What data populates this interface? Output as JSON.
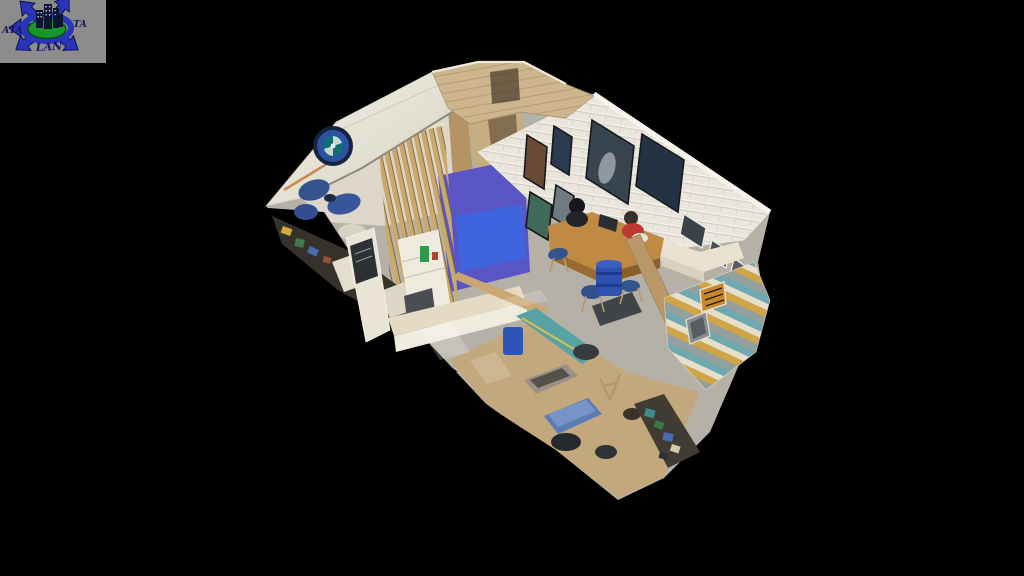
{
  "app": {
    "kind": "3d-dollhouse-tour-viewer",
    "background_color": "#000000"
  },
  "watermark": {
    "text_left": "ATA",
    "text_right": "TA",
    "text_bottom": "LAN",
    "colors": {
      "panel": "#8c8c8c",
      "arrows": "#2935b8",
      "arrow_outline": "#10104f",
      "globe_green": "#18962e",
      "buildings": "#0e1530",
      "windows": "#c8d0e0",
      "text": "#181864"
    }
  },
  "scene": {
    "kind": "dollhouse-cutaway",
    "features": [
      "white-brick-wall-with-framed-art",
      "wood-slat-partition-with-purple-glow",
      "reception-desk-with-two-people",
      "dartboard",
      "blue-lounge-seating",
      "workshop-floor-with-benches",
      "blue-padded-bench",
      "blue-barrel",
      "teal-striped-staircase",
      "tiger-picture",
      "cutaway-cream-walls"
    ],
    "colors": {
      "floor": "#b6b1a7",
      "floor_tan": "#c3a87e",
      "roof": "#eceade",
      "wall_cream": "#e9e4d6",
      "wood_wall": "#cdb58e",
      "brick": "#eae6dd",
      "slat_wood": "#c9a96b",
      "glow_purple": "#5a55c5",
      "glow_blue": "#4064dd",
      "desk_wood": "#c08a45",
      "seat_blue": "#35548e",
      "barrel_blue": "#2e52b2",
      "bench_blue": "#5b7cb4",
      "machine_teal": "#57a2a4",
      "stair_teal": "#6fa8b0",
      "stair_mustard": "#cfa548",
      "painting_dark": "#2c3a50",
      "person_red": "#bc3832",
      "person_dark": "#17171c"
    }
  }
}
